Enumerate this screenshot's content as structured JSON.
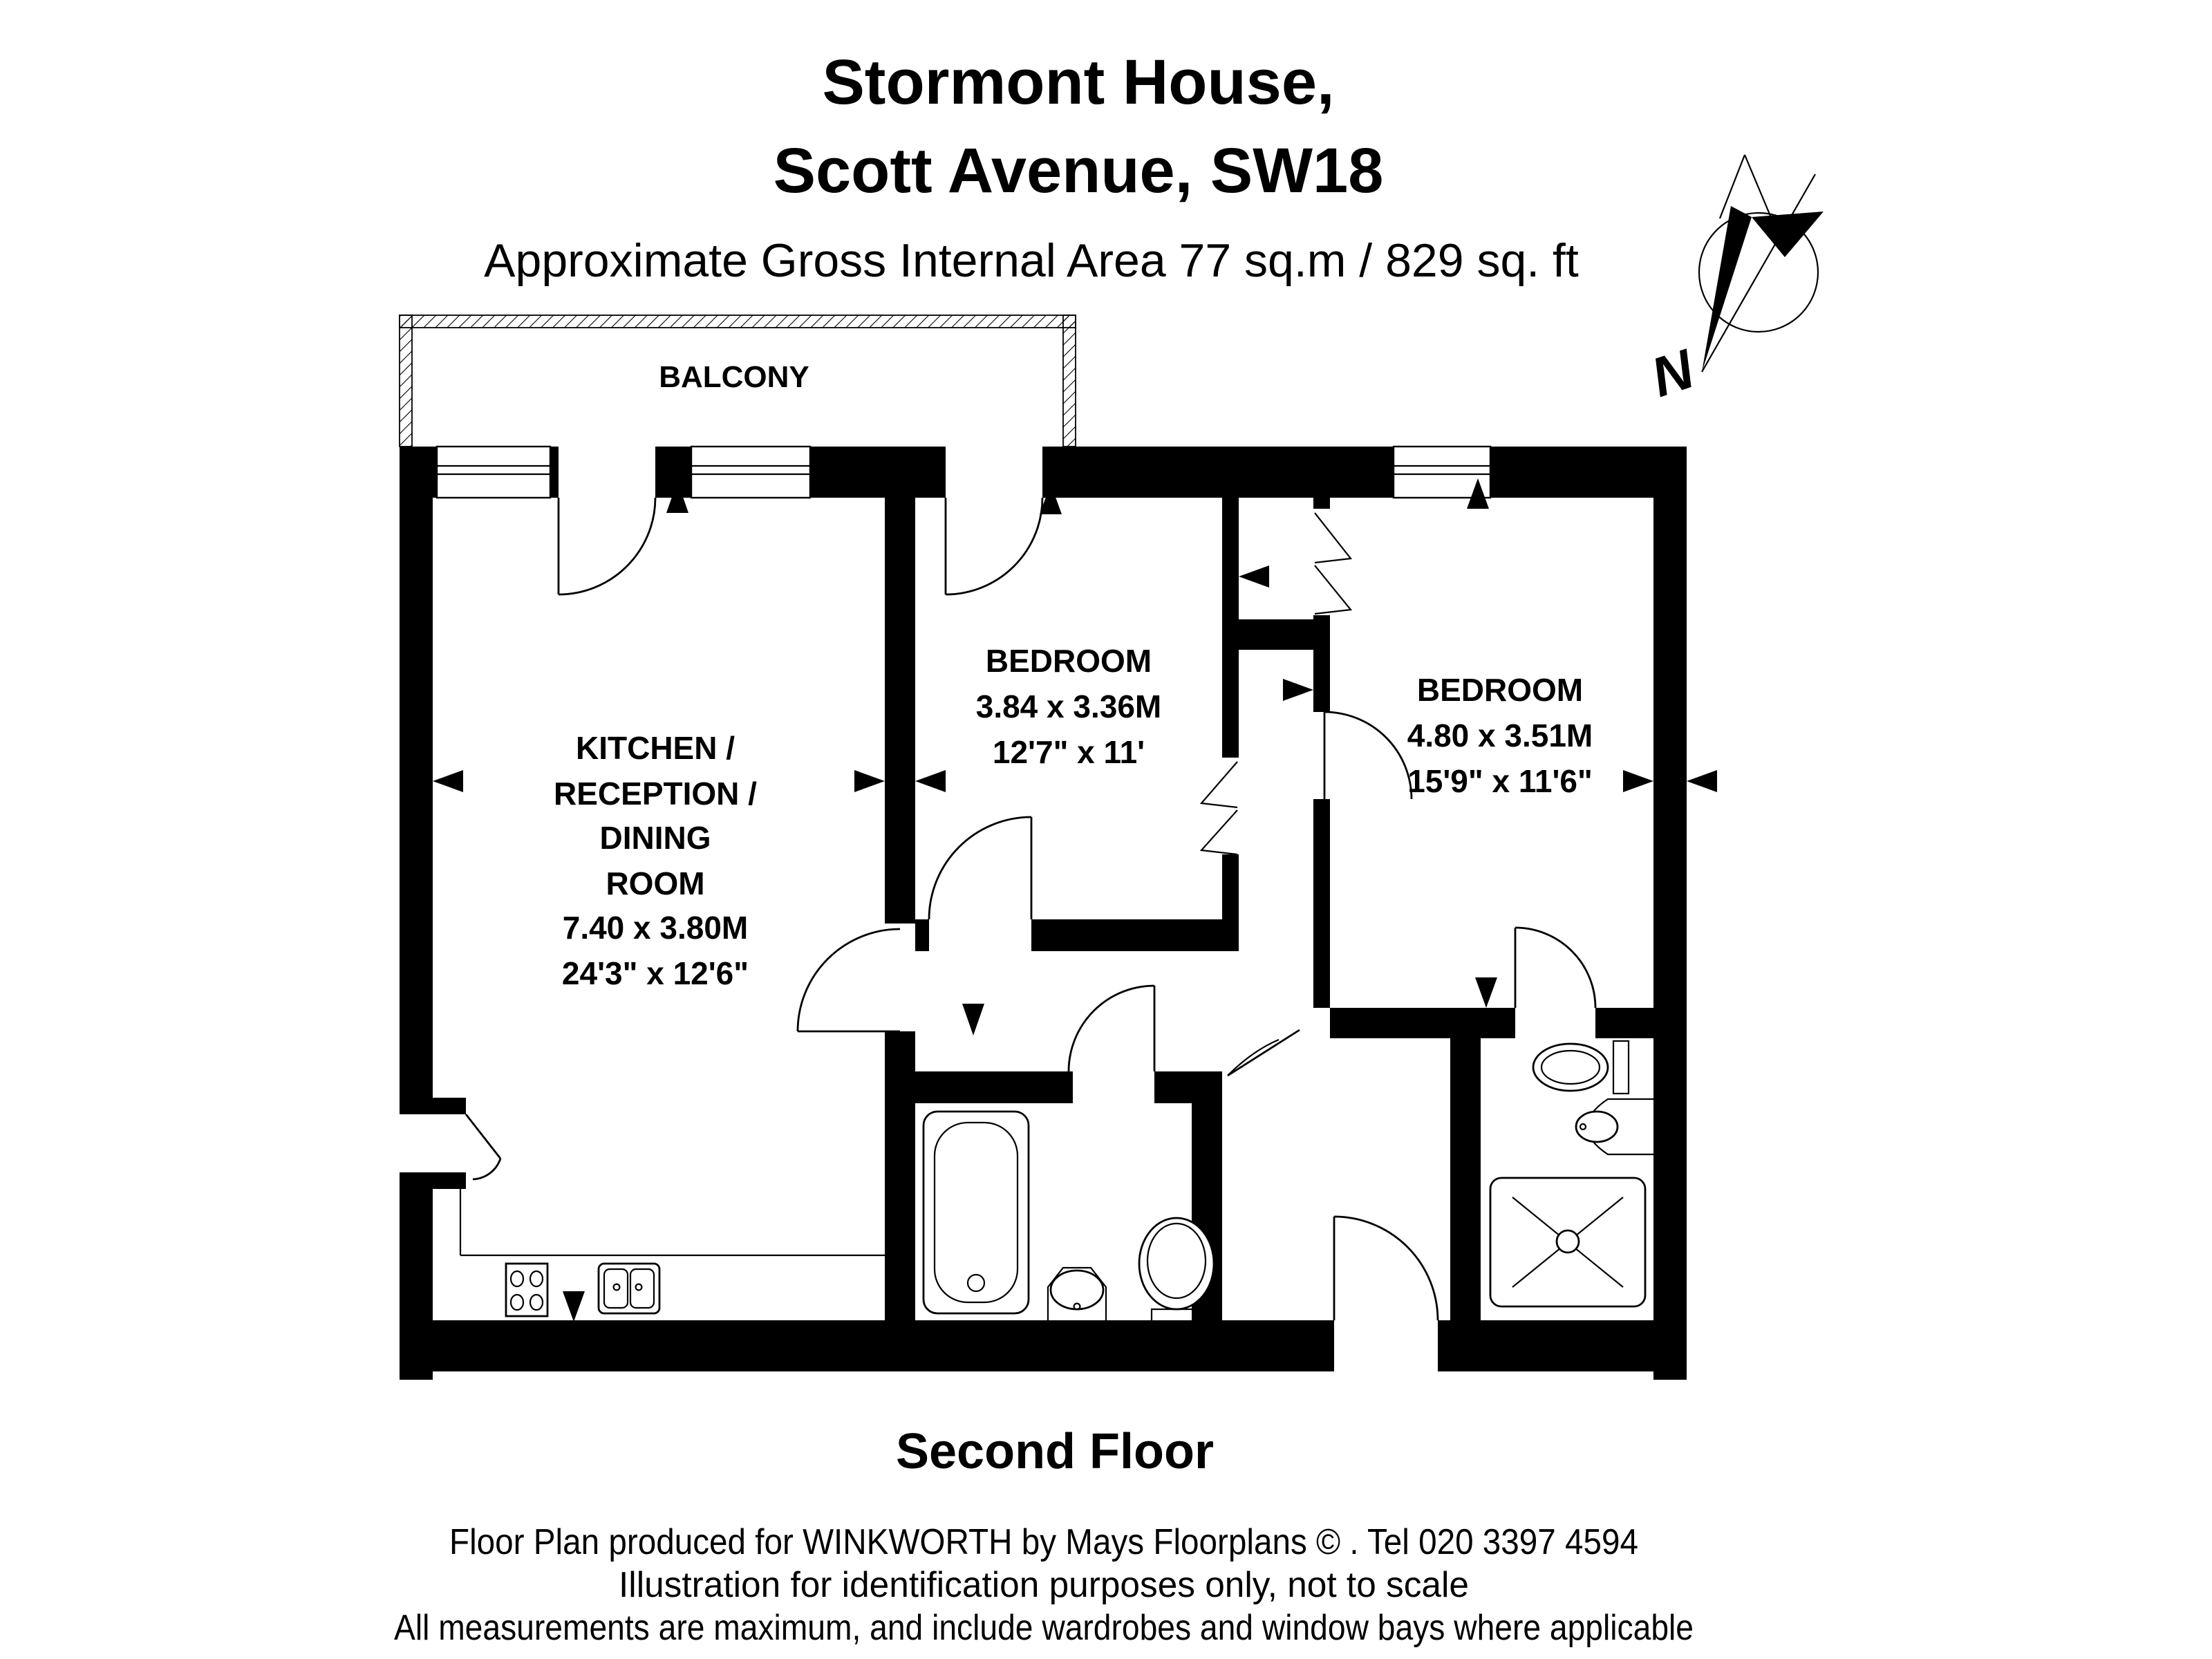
{
  "header": {
    "title_line1": "Stormont House,",
    "title_line2": "Scott Avenue, SW18",
    "subtitle": "Approximate Gross Internal Area 77 sq.m / 829 sq. ft"
  },
  "compass": {
    "label": "N"
  },
  "plan": {
    "balcony_label": "BALCONY",
    "rooms": [
      {
        "name": "kitchen-reception-dining",
        "label_lines": [
          "KITCHEN /",
          "RECEPTION /",
          "DINING",
          "ROOM",
          "7.40 x 3.80M",
          "24'3\" x 12'6\""
        ]
      },
      {
        "name": "bedroom-1",
        "label_lines": [
          "BEDROOM",
          "3.84 x 3.36M",
          "12'7\" x 11'"
        ]
      },
      {
        "name": "bedroom-2",
        "label_lines": [
          "BEDROOM",
          "4.80 x 3.51M",
          "15'9\" x 11'6\""
        ]
      }
    ],
    "icons": [
      "compass-rose-icon",
      "bathtub-icon",
      "pedestal-sink-icon",
      "toilet-icon",
      "shower-tray-icon",
      "hob-icon",
      "double-sink-icon",
      "bifold-wardrobe-doors-icon",
      "door-swing-icon",
      "dimension-arrow-icon",
      "window-icon",
      "hatched-balcony-border-icon"
    ],
    "colors": {
      "walls": "#000000",
      "background": "#ffffff"
    }
  },
  "floor_label": "Second Floor",
  "footer": {
    "line1": "Floor Plan produced for WINKWORTH by Mays Floorplans  © . Tel 020 3397 4594",
    "line2": "Illustration for identification purposes only, not to scale",
    "line3": "All measurements are maximum, and include wardrobes and window bays where applicable"
  }
}
